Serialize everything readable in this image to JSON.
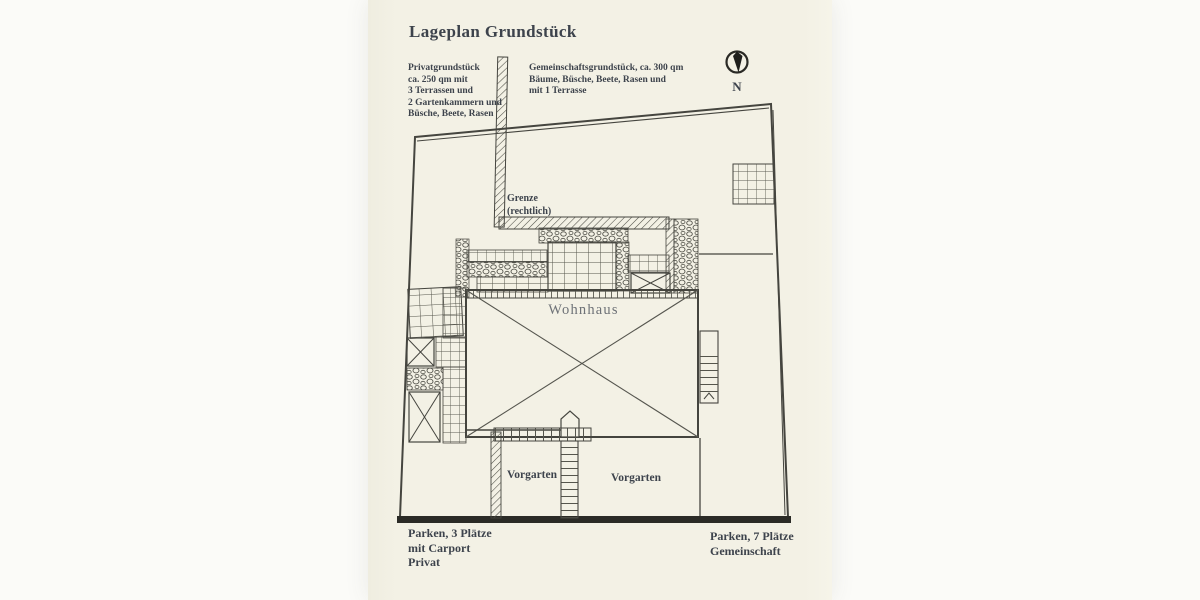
{
  "page": {
    "title": "Lageplan Grundstück"
  },
  "legend": {
    "private": {
      "lines": [
        "Privatgrundstück",
        "ca. 250 qm mit",
        "3 Terrassen und",
        "2 Gartenkammern und",
        "Büsche, Beete, Rasen"
      ]
    },
    "common": {
      "lines": [
        "Gemeinschaftsgrundstück, ca. 300 qm",
        "Bäume, Büsche, Beete, Rasen und",
        "mit 1 Terrasse"
      ]
    }
  },
  "compass": {
    "north_label": "N"
  },
  "plan": {
    "boundary_label": {
      "lines": [
        "Grenze",
        "(rechtlich)"
      ]
    },
    "house_label": "Wohnhaus",
    "front_garden_left_label": "Vorgarten",
    "front_garden_right_label": "Vorgarten"
  },
  "parking": {
    "private": {
      "lines": [
        "Parken, 3 Plätze",
        "mit Carport",
        "Privat"
      ]
    },
    "common": {
      "lines": [
        "Parken, 7 Plätze",
        "Gemeinschaft"
      ]
    }
  },
  "colors": {
    "paper": "#f3f1e5",
    "background": "#fbfbf8",
    "ink": "#45453f",
    "ink-dark": "#2a2a25",
    "text": "#3d434c",
    "house-label": "#6e7277"
  }
}
